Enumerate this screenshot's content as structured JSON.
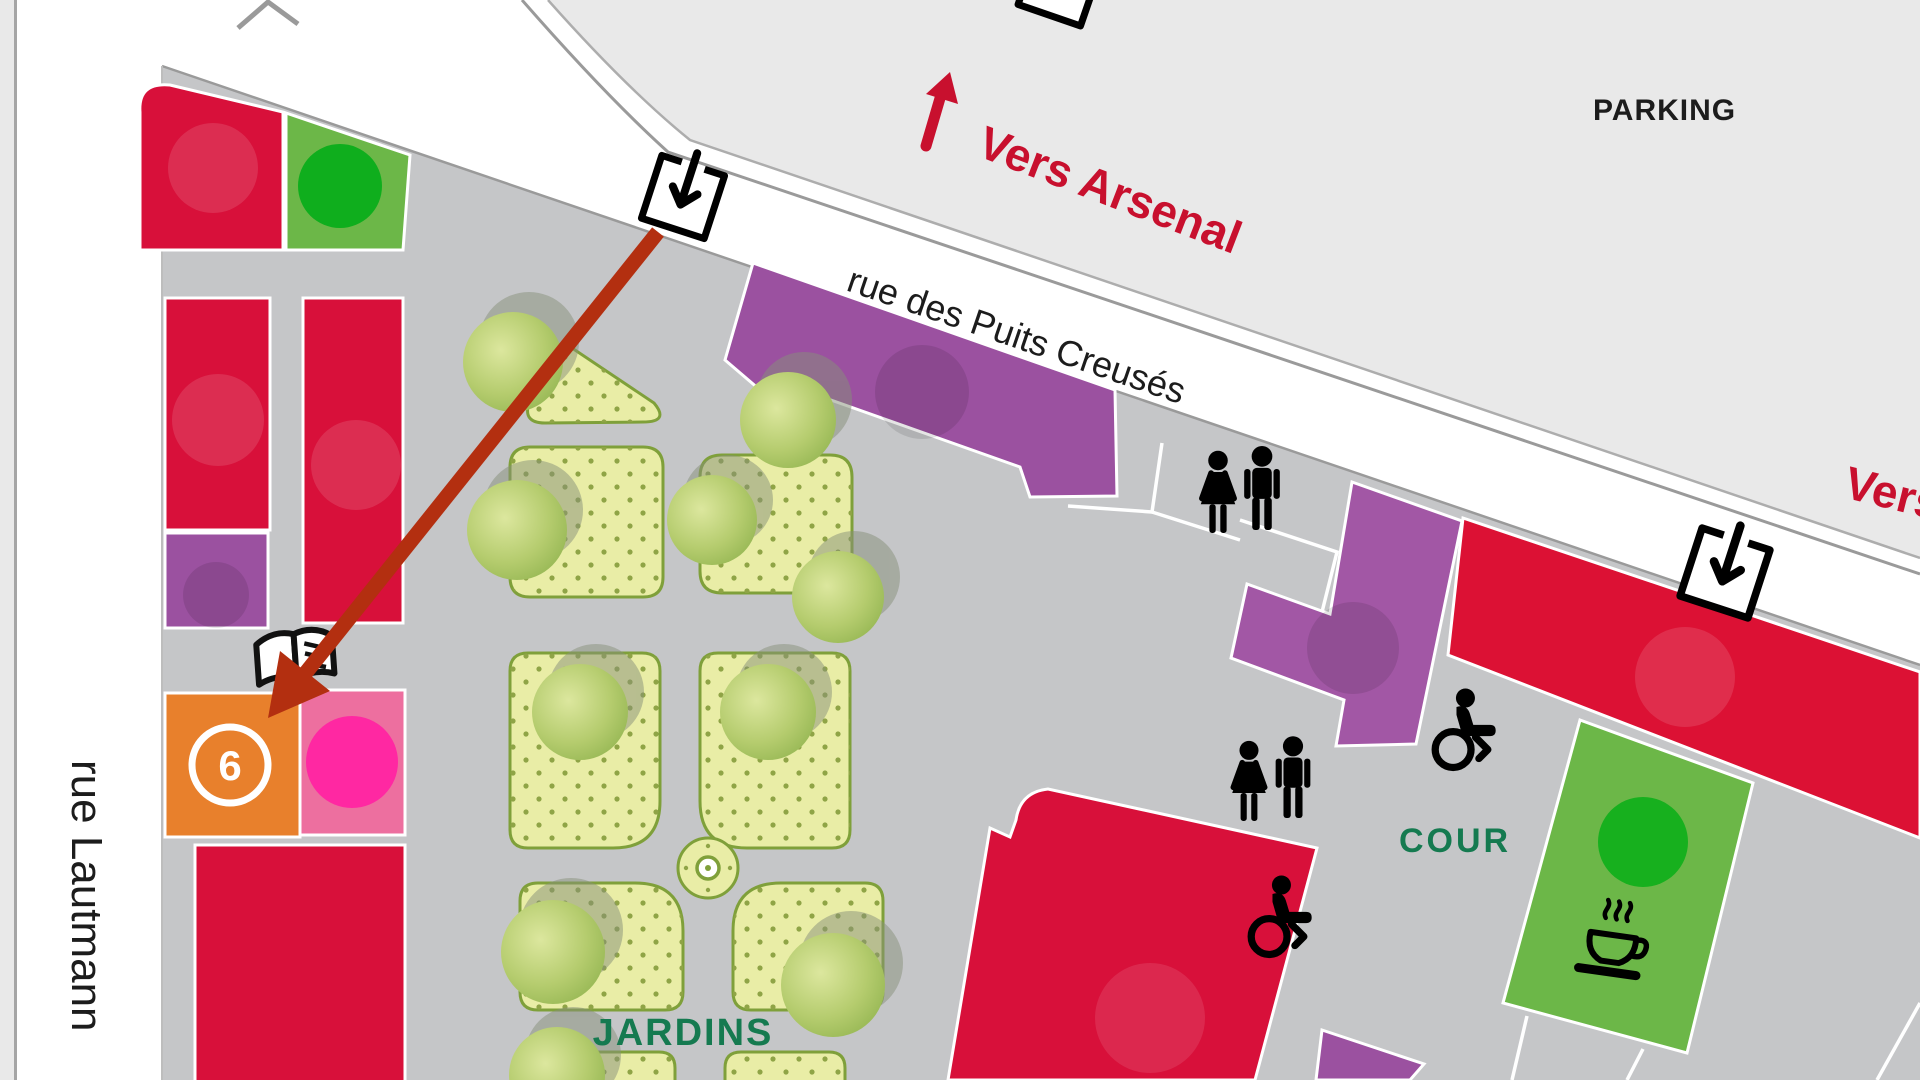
{
  "labels": {
    "parking": "PARKING",
    "direction_arsenal": "Vers Arsenal",
    "direction_east": "Vers",
    "street_top": "rue des Puits Creusés",
    "street_left": "rue Lautmann",
    "gardens": "JARDINS",
    "courtyard": "COUR",
    "venue_number": "6"
  },
  "icons": {
    "entrance": "square-down-arrow-entrance",
    "toilets": "man-and-woman-figures",
    "wheelchair": "wheelchair-access",
    "cafe": "coffee-cup",
    "reading_point": "open-book",
    "route": "red-route-arrow",
    "direction": "red-up-arrow"
  },
  "colors": {
    "building_red": "#d8103a",
    "building_purple": "#9b51a0",
    "building_green": "#6cb748",
    "building_orange": "#e8802c",
    "building_pink": "#ed6f9f",
    "circle_green": "#12ac1e",
    "circle_pink": "#ff28a2",
    "plaza_gray": "#c5c6c8",
    "background_gray": "#e9e9e9",
    "street_white": "#ffffff",
    "garden_bed": "#e9eda6",
    "garden_border": "#7fa03a",
    "label_red": "#c8102e",
    "label_green": "#157a50",
    "route_arrow_red": "#b32f10",
    "text_black": "#1c1c1c"
  }
}
